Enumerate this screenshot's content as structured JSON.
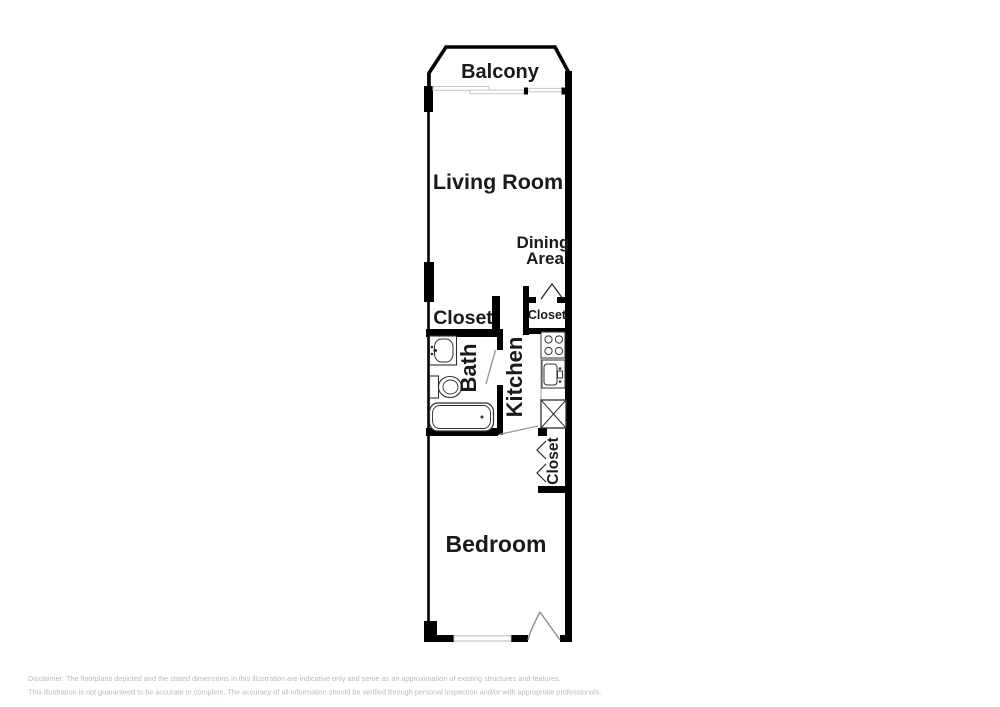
{
  "meta": {
    "type": "floorplan-illustration",
    "background_color": "#ffffff",
    "wall_color": "#000000",
    "fixture_line_color": "#3a3a3a",
    "light_line_color": "#c4c6ca",
    "disclaimer_color": "#b4bbc7"
  },
  "rooms": {
    "balcony": {
      "label": "Balcony"
    },
    "living_room": {
      "label": "Living Room"
    },
    "dining_area": {
      "label_line1": "Dining",
      "label_line2": "Area"
    },
    "closet_upper_left": {
      "label": "Closet"
    },
    "closet_upper_right": {
      "label": "Closet"
    },
    "bath": {
      "label": "Bath"
    },
    "kitchen": {
      "label": "Kitchen"
    },
    "closet_lower_right": {
      "label": "Closet"
    },
    "bedroom": {
      "label": "Bedroom"
    }
  },
  "fixtures": {
    "bath": [
      "vanity-sink",
      "toilet",
      "bathtub"
    ],
    "kitchen": [
      "stove",
      "kitchen-sink",
      "refrigerator"
    ],
    "doors": [
      "balcony-sliding-door",
      "upper-closet-swing-door",
      "bath-swing-door",
      "hall-swing-door",
      "lower-closet-bifold-door",
      "bedroom-entry-door"
    ],
    "windows": [
      "bedroom-window"
    ]
  },
  "disclaimer": {
    "line1": "Disclaimer: The floorplans depicted and the stated dimensions in this illustration are indicative only and serve as an approximation of existing structures and features.",
    "line2": "This illustration is not guaranteed to be accurate or complete. The accuracy of all information should be verified through personal inspection and/or with appropriate professionals."
  }
}
